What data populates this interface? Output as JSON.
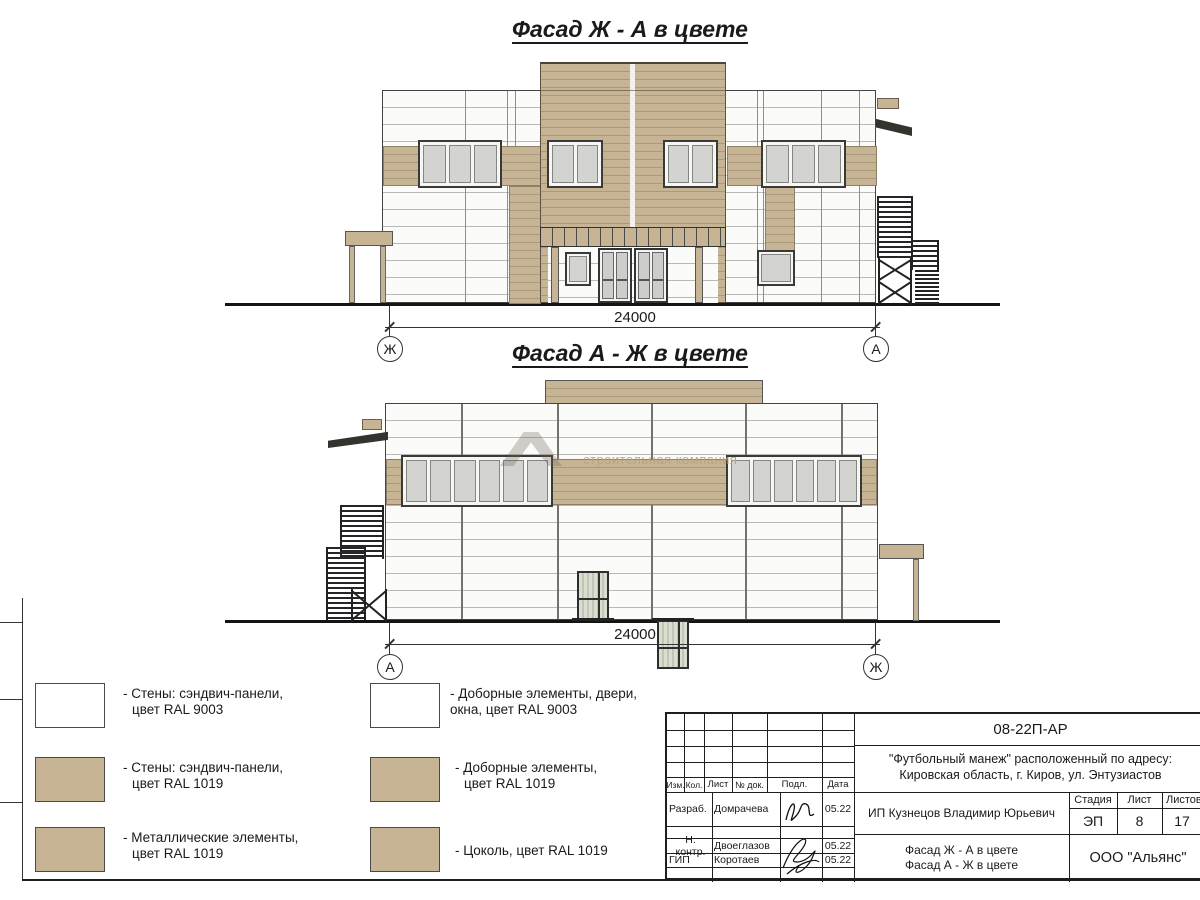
{
  "facade1": {
    "title": "Фасад Ж - А в цвете",
    "dimension": "24000",
    "axis_left": "Ж",
    "axis_right": "А"
  },
  "facade2": {
    "title": "Фасад А - Ж в цвете",
    "dimension": "24000",
    "axis_left": "А",
    "axis_right": "Ж"
  },
  "watermark": "строительная компания",
  "legend": {
    "col1": [
      {
        "line1": "- Стены: сэндвич-панели,",
        "line2": "цвет RAL 9003",
        "color": "#ffffff"
      },
      {
        "line1": "- Стены: сэндвич-панели,",
        "line2": "цвет RAL 1019",
        "color": "#c6b495"
      },
      {
        "line1": "- Металлические элементы,",
        "line2": "цвет RAL 1019",
        "color": "#c6b495"
      }
    ],
    "col2": [
      {
        "line1": "- Доборные элементы, двери,",
        "line2": "окна, цвет RAL 9003",
        "color": "#ffffff"
      },
      {
        "line1": "- Доборные элементы,",
        "line2": "цвет RAL 1019",
        "color": "#c6b495"
      },
      {
        "line1": "- Цоколь, цвет RAL 1019",
        "line2": "",
        "color": "#c6b495"
      }
    ]
  },
  "title_block": {
    "doc_number": "08-22П-АР",
    "project_line1": "\"Футбольный манеж\" расположенный по адресу:",
    "project_line2": "Кировская область, г. Киров, ул. Энтузиастов",
    "col_izm": "Изм.",
    "col_kol": "Кол.",
    "col_list": "Лист",
    "col_ndoc": "№ док.",
    "col_podp": "Подл.",
    "col_data": "Дата",
    "rows": [
      {
        "role": "Разраб.",
        "name": "Домрачева",
        "date": "05.22"
      },
      {
        "role": "Н. контр.",
        "name": "Двоеглазов",
        "date": "05.22"
      },
      {
        "role": "ГИП",
        "name": "Коротаев",
        "date": "05.22"
      }
    ],
    "client": "ИП Кузнецов Владимир Юрьевич",
    "stage_label": "Стадия",
    "stage": "ЭП",
    "sheet_label": "Лист",
    "sheet_num": "8",
    "sheets_label": "Листов",
    "sheets_total": "17",
    "sheet_title_line1": "Фасад Ж - А в цвете",
    "sheet_title_line2": "Фасад А - Ж в цвете",
    "company": "ООО \"Альянс\""
  },
  "colors": {
    "ral1019_render": "#c6b495",
    "ral9003_render": "#ffffff",
    "line": "#333333"
  }
}
